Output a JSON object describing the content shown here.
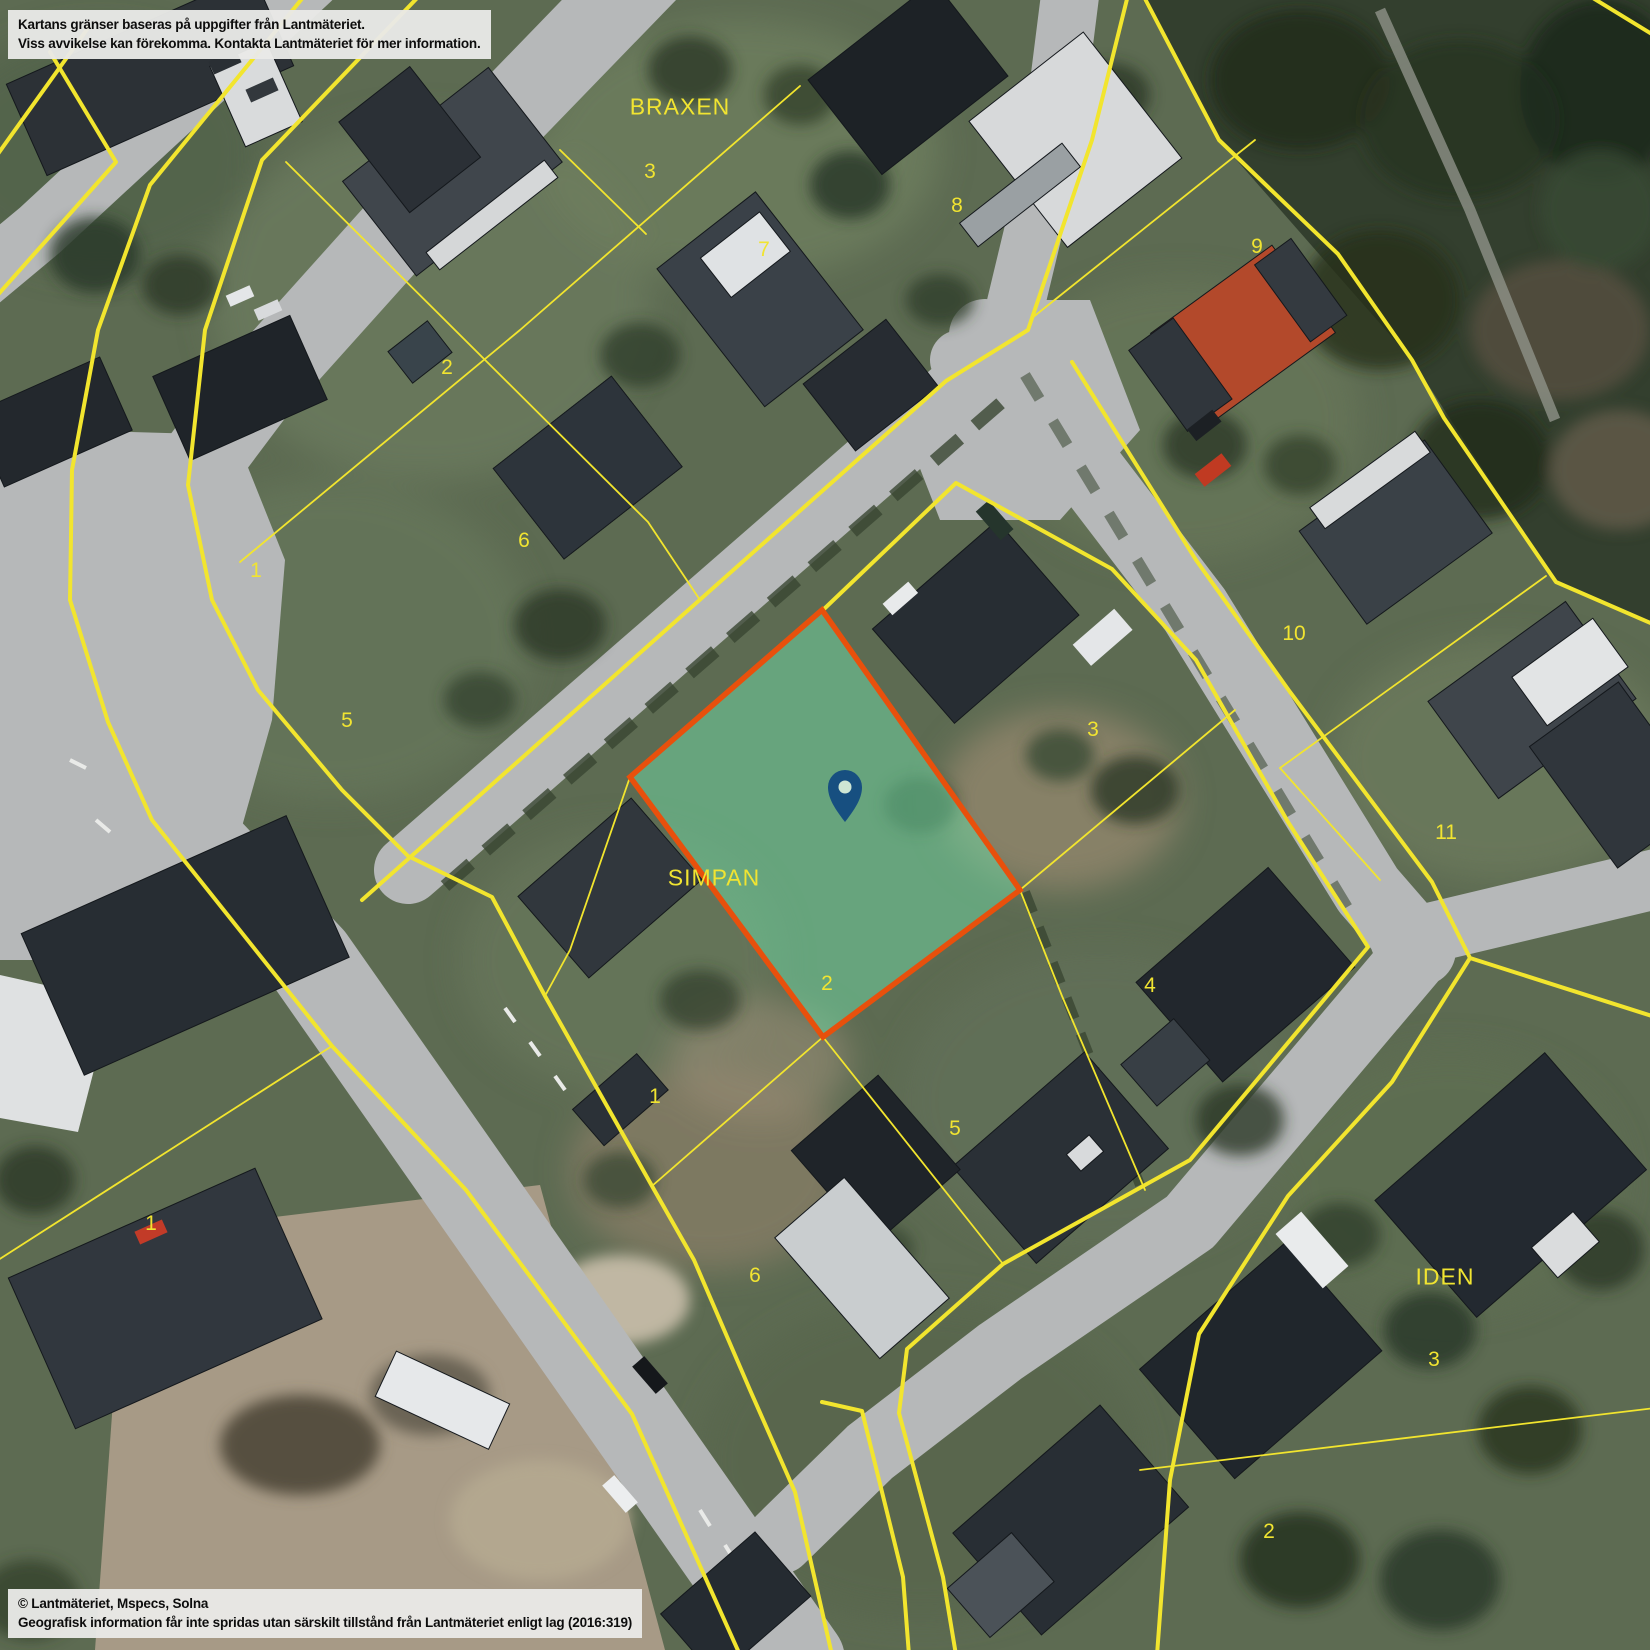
{
  "attribution": {
    "disclaimer_line1": "Kartans gränser baseras på uppgifter från Lantmäteriet.",
    "disclaimer_line2": "Viss avvikelse kan förekomma. Kontakta Lantmäteriet för mer information.",
    "copyright_line1": "© Lantmäteriet, Mspecs, Solna",
    "copyright_line2": "Geografisk information får inte spridas utan särskilt tillstånd från Lantmäteriet enligt lag (2016:319)"
  },
  "map": {
    "colors": {
      "boundary_line": "#f2e52e",
      "label_text": "#f1e431",
      "parcel_fill": "#6fd3a0",
      "parcel_stroke": "#e8500c",
      "pin_color": "#174f80",
      "pin_inner": "#cfe6d4"
    },
    "labels": [
      {
        "text": "BRAXEN",
        "x": 680,
        "y": 107,
        "kind": "block"
      },
      {
        "text": "SIMPAN",
        "x": 714,
        "y": 878,
        "kind": "block"
      },
      {
        "text": "IDEN",
        "x": 1445,
        "y": 1277,
        "kind": "block"
      },
      {
        "text": "3",
        "x": 650,
        "y": 172,
        "kind": "number"
      },
      {
        "text": "7",
        "x": 764,
        "y": 250,
        "kind": "number"
      },
      {
        "text": "8",
        "x": 957,
        "y": 206,
        "kind": "number"
      },
      {
        "text": "9",
        "x": 1257,
        "y": 247,
        "kind": "number"
      },
      {
        "text": "2",
        "x": 447,
        "y": 368,
        "kind": "number"
      },
      {
        "text": "6",
        "x": 524,
        "y": 541,
        "kind": "number"
      },
      {
        "text": "1",
        "x": 256,
        "y": 571,
        "kind": "number"
      },
      {
        "text": "5",
        "x": 347,
        "y": 721,
        "kind": "number"
      },
      {
        "text": "10",
        "x": 1294,
        "y": 634,
        "kind": "number"
      },
      {
        "text": "3",
        "x": 1093,
        "y": 730,
        "kind": "number"
      },
      {
        "text": "11",
        "x": 1446,
        "y": 833,
        "kind": "number"
      },
      {
        "text": "4",
        "x": 1150,
        "y": 986,
        "kind": "number"
      },
      {
        "text": "2",
        "x": 827,
        "y": 984,
        "kind": "number"
      },
      {
        "text": "1",
        "x": 655,
        "y": 1097,
        "kind": "number"
      },
      {
        "text": "5",
        "x": 955,
        "y": 1129,
        "kind": "number"
      },
      {
        "text": "6",
        "x": 755,
        "y": 1276,
        "kind": "number"
      },
      {
        "text": "1",
        "x": 151,
        "y": 1224,
        "kind": "number"
      },
      {
        "text": "3",
        "x": 1434,
        "y": 1360,
        "kind": "number"
      },
      {
        "text": "2",
        "x": 1269,
        "y": 1532,
        "kind": "number"
      }
    ],
    "highlighted_parcel": {
      "block": "SIMPAN",
      "number": "2",
      "points": "822,610 1020,890 823,1037 630,777",
      "fill": "#6fd3a0",
      "fill_opacity": 0.55,
      "stroke": "#e8500c",
      "stroke_width": 5.5
    },
    "pin": {
      "x": 845,
      "y": 793
    }
  }
}
